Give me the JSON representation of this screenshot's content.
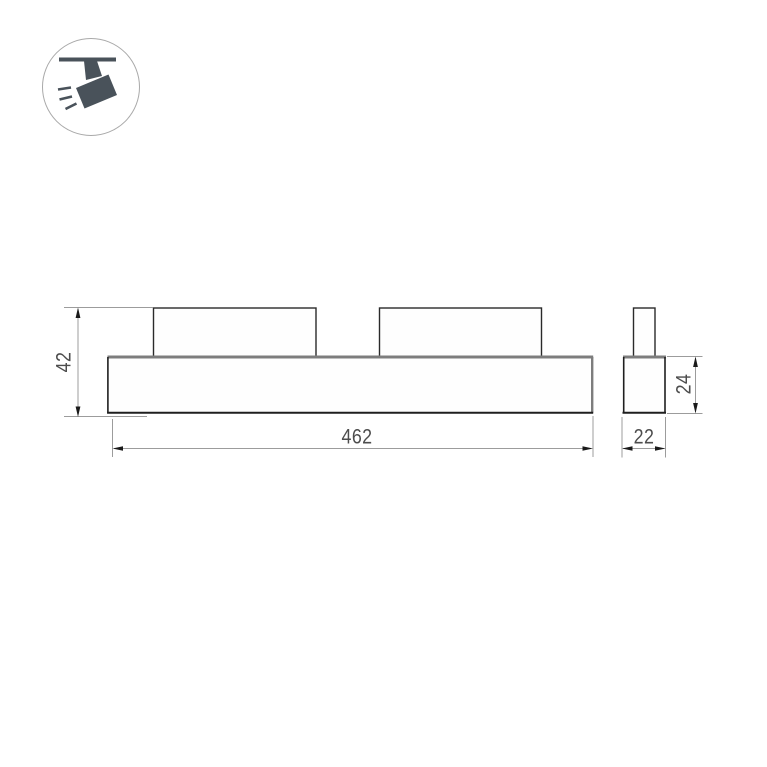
{
  "page": {
    "background": "#ffffff",
    "description_label": ""
  },
  "colors": {
    "outline_dark": "#1f1f1f",
    "outline_soft": "#7d7d7d",
    "block_outline": "#2a2a2a",
    "dim_line": "#9c9c9c",
    "arrow": "#1a1a1a",
    "dim_text": "#4d4d4d",
    "shape_fill": "#fefefe",
    "icon_glyph": "#49525a",
    "icon_circle_border": "#a9a9a9",
    "icon_circle_fill": "#ffffff"
  },
  "icon": {
    "name": "track-spotlight-icon"
  },
  "drawing": {
    "front_view": {
      "width_label": "462",
      "height_label": "42"
    },
    "side_view": {
      "width_label": "22",
      "height_label": "24"
    }
  }
}
